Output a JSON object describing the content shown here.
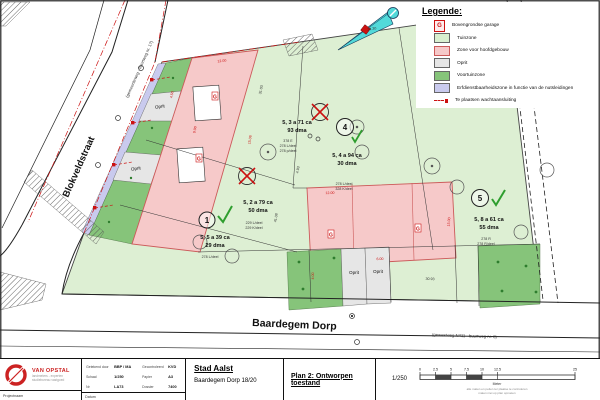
{
  "colors": {
    "site_green": "#ddefd3",
    "voortuin_green": "#86c47a",
    "zone_pink": "#f6c9c9",
    "pink_border": "#cc5a5a",
    "oprit_grey": "#e6e6e6",
    "easement_purple": "#c9caee",
    "accent_red": "#cc1111",
    "check_green": "#2f9e2f",
    "north_teal": "#52d9d9",
    "dim_black": "#333333"
  },
  "legend": {
    "title": "Legende:",
    "items": [
      {
        "label": "Bovengrondse garage",
        "symbol": "G"
      },
      {
        "label": "Tuinzone"
      },
      {
        "label": "Zone voor hoofdgebouw"
      },
      {
        "label": "Oprit"
      },
      {
        "label": "Voortuinzone"
      },
      {
        "label": "Erfdienstbaarheidszone in functie van de nutsleidingen"
      },
      {
        "label": "Te plaatsen wachtaansluiting"
      }
    ]
  },
  "map": {
    "roads": {
      "left_name": "Blokveldstraat",
      "left_sub": "(gemeenteweg - buurtweg nr. 17)",
      "bottom_name": "Baardegem Dorp",
      "bottom_sub": "(gewestweg N411 - buurtweg nr. 8)"
    },
    "oprit": "Oprit",
    "lots": [
      {
        "no": "1",
        "line1": "5, 5 a 39 ca",
        "line2": "29 dma",
        "parcels": [
          "278 L/deel"
        ]
      },
      {
        "no": "2",
        "line1": "5, 2 a 79 ca",
        "line2": "50 dma",
        "parcels": [
          "229 L/deel",
          "229 K/deel"
        ]
      },
      {
        "no": "3",
        "line1": "5, 3 a 71 ca",
        "line2": "93 dma",
        "parcels": [
          "378 E",
          "278 L/deel",
          "278 p/deel"
        ]
      },
      {
        "no": "4",
        "line1": "5, 4 a 94 ca",
        "line2": "30 dma",
        "parcels": [
          "278 L/deel",
          "328 K/deel"
        ]
      },
      {
        "no": "5",
        "line1": "5, 8 a 61 ca",
        "line2": "55 dma",
        "parcels": [
          "278 R",
          "278 R/deel"
        ]
      }
    ],
    "dims": [
      {
        "t": "34.30",
        "c": "#333333"
      },
      {
        "t": "4.93",
        "c": "#333333"
      },
      {
        "t": "41.08",
        "c": "#333333"
      },
      {
        "t": "30.93",
        "c": "#333333"
      },
      {
        "t": "31.03",
        "c": "#333333"
      },
      {
        "t": "12.00",
        "c": "#cc1111"
      },
      {
        "t": "15.06",
        "c": "#cc1111"
      },
      {
        "t": "4.50",
        "c": "#cc1111"
      },
      {
        "t": "9.00",
        "c": "#cc1111"
      },
      {
        "t": "12.00",
        "c": "#cc1111"
      },
      {
        "t": "15.00",
        "c": "#cc1111"
      },
      {
        "t": "6.00",
        "c": "#cc1111"
      },
      {
        "t": "4.00",
        "c": "#cc1111"
      }
    ],
    "garage_symbol": "G"
  },
  "titleblock": {
    "company": "VAN OPSTAL",
    "company_sub1": "landmeters - experten",
    "company_sub2": "studiebureau vastgoed",
    "meta": {
      "g_label": "Getekend door",
      "g_value": "BBP / MA",
      "c_label": "Gecontroleerd",
      "c_value": "KVD",
      "s_label": "Schaal",
      "s_value": "1/250",
      "p_label": "Papier",
      "p_value": "A3",
      "n_label": "Nr",
      "n_value": "LA73",
      "d_label": "Dossier",
      "d_value": "7400"
    },
    "footer_left": "Projectnaam",
    "footer_right": "Datum",
    "city": "Stad Aalst",
    "project": "Baardegem Dorp 18/20",
    "plan_title": "Plan 2: Ontworpen toestand",
    "scale_label": "1/250",
    "scale_ticks": [
      "0",
      "2.5",
      "5",
      "7.5",
      "10",
      "12.5",
      "25"
    ],
    "scale_unit": "Meter",
    "scale_note1": "alle maten en peilen ter plaatse te controleren",
    "scale_note2": "maten niet op plan opmeten"
  }
}
